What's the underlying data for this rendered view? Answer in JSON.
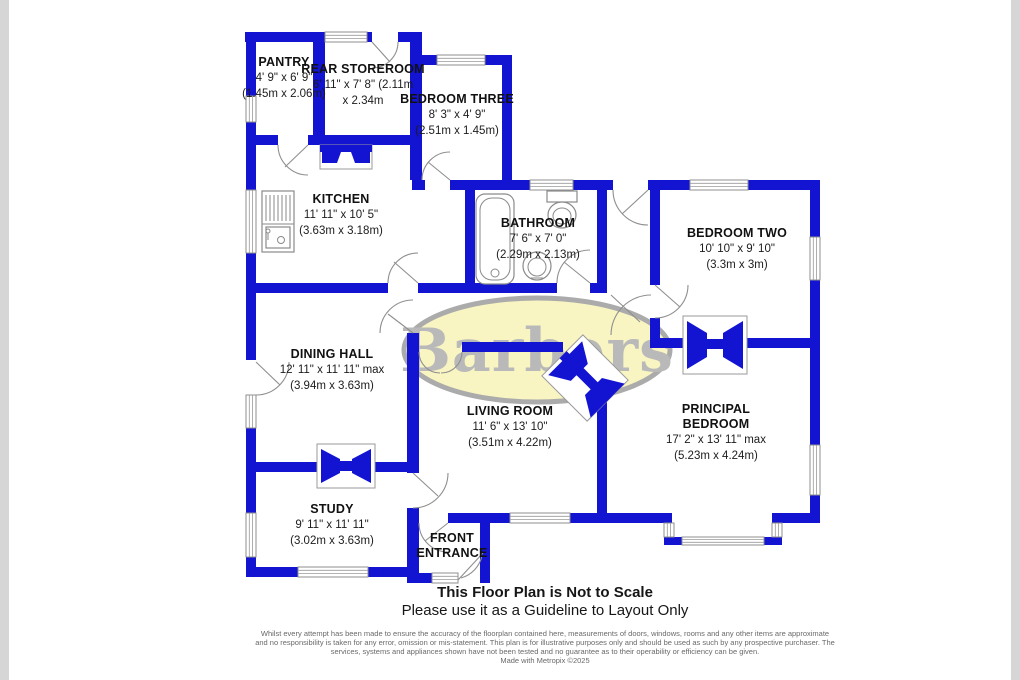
{
  "watermark": {
    "text": "Barbers"
  },
  "rooms": {
    "pantry": {
      "name": "PANTRY",
      "dims": "4' 9\" x 6' 9\"",
      "metric": "(1.45m x 2.06m)"
    },
    "rear_storeroom": {
      "name": "REAR STOREROOM",
      "dims": "6' 11\" x 7' 8\" (2.11m",
      "metric": "x 2.34m"
    },
    "bedroom_three": {
      "name": "BEDROOM THREE",
      "dims": "8' 3\" x 4' 9\"",
      "metric": "(2.51m x 1.45m)"
    },
    "kitchen": {
      "name": "KITCHEN",
      "dims": "11' 11\" x 10' 5\"",
      "metric": "(3.63m x 3.18m)"
    },
    "bathroom": {
      "name": "BATHROOM",
      "dims": "7' 6\" x 7' 0\"",
      "metric": "(2.29m x 2.13m)"
    },
    "bedroom_two": {
      "name": "BEDROOM TWO",
      "dims": "10' 10\" x 9' 10\"",
      "metric": "(3.3m x 3m)"
    },
    "dining_hall": {
      "name": "DINING HALL",
      "dims": "12' 11\" x 11' 11\" max",
      "metric": "(3.94m x 3.63m)"
    },
    "living_room": {
      "name": "LIVING ROOM",
      "dims": "11' 6\" x 13' 10\"",
      "metric": "(3.51m x 4.22m)"
    },
    "principal_bedroom": {
      "name1": "PRINCIPAL",
      "name2": "BEDROOM",
      "dims": "17' 2\" x 13' 11\" max",
      "metric": "(5.23m x 4.24m)"
    },
    "study": {
      "name": "STUDY",
      "dims": "9' 11\" x 11' 11\"",
      "metric": "(3.02m x 3.63m)"
    },
    "front_entrance": {
      "name1": "FRONT",
      "name2": "ENTRANCE"
    }
  },
  "footer": {
    "line1": "This Floor Plan is Not to Scale",
    "line2": "Please use it as a Guideline to Layout Only",
    "disclaimer": "Whilst every attempt has been made to ensure the accuracy of the floorplan contained here, measurements of doors, windows, rooms and any other items are approximate and no responsibility is taken for any error, omission or mis-statement. This plan is for illustrative purposes only and should be used as such by any prospective purchaser. The services, systems and appliances shown have not been tested and no guarantee as to their operability or efficiency can be given.",
    "credit": "Made with Metropix ©2025"
  },
  "colors": {
    "wall": "#1313d2",
    "wm-fill": "#f8f5c2",
    "wm-ring": "#ababab",
    "wm-text": "#b9b9b9",
    "edge": "#d6d6d6",
    "disc": "#696969"
  }
}
